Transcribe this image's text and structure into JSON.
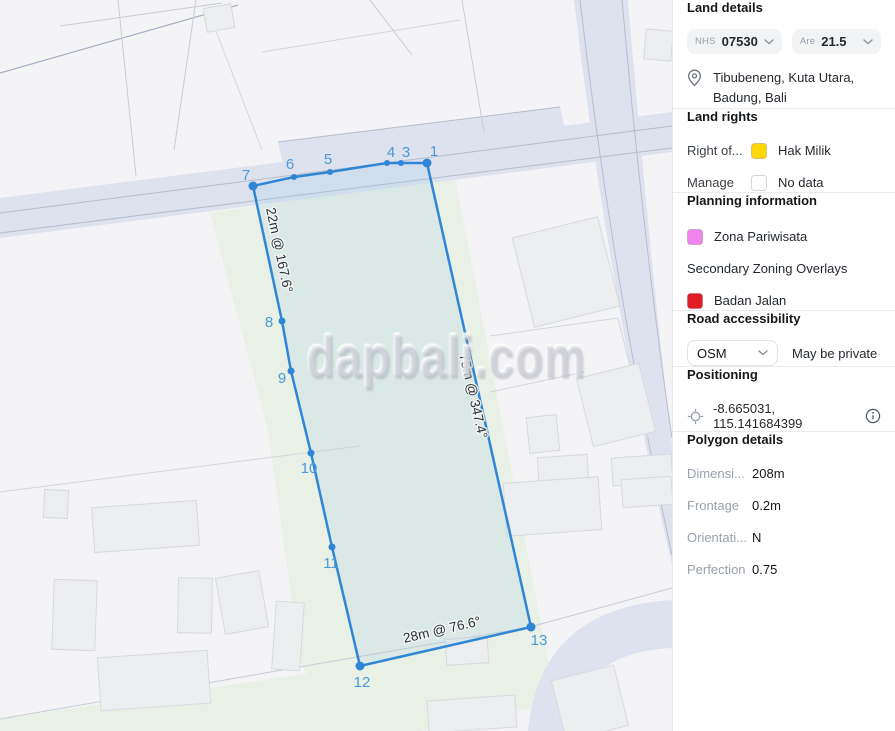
{
  "map": {
    "watermark": "dapbali.com",
    "colors": {
      "parcel_stroke": "#2F86D6"
    },
    "edge_labels": {
      "left": "22m @ 167.6°",
      "right": "75m @ 347.4°",
      "bottom": "28m @ 76.6°"
    },
    "vertex_labels": {
      "n1": "1",
      "n3": "3",
      "n4": "4",
      "n5": "5",
      "n6": "6",
      "n7": "7",
      "n8": "8",
      "n9": "9",
      "n10": "10",
      "n11": "11",
      "n12": "12",
      "n13": "13"
    }
  },
  "sidebar": {
    "land_details": {
      "title": "Land details",
      "nhs": {
        "label": "NHS",
        "value": "07530"
      },
      "are": {
        "label": "Are",
        "value": "21.5"
      },
      "location": "Tibubeneng, Kuta Utara, Badung, Bali"
    },
    "land_rights": {
      "title": "Land rights",
      "rows": [
        {
          "label": "Right of...",
          "value": "Hak Milik",
          "swatch": "#FFD60A"
        },
        {
          "label": "Manage",
          "value": "No data",
          "swatch": "#FFFFFF"
        }
      ]
    },
    "planning": {
      "title": "Planning information",
      "primary": {
        "label": "Zona Pariwisata",
        "swatch": "#F083EC"
      },
      "secondary_title": "Secondary Zoning Overlays",
      "secondary": {
        "label": "Badan Jalan",
        "swatch": "#E11D26"
      }
    },
    "road_accessibility": {
      "title": "Road accessibility",
      "source": "OSM",
      "note": "May be private"
    },
    "positioning": {
      "title": "Positioning",
      "coordinates": "-8.665031, 115.141684399"
    },
    "polygon_details": {
      "title": "Polygon details",
      "rows": [
        {
          "label": "Dimensi...",
          "value": "208m"
        },
        {
          "label": "Frontage",
          "value": "0.2m"
        },
        {
          "label": "Orientati...",
          "value": "N"
        },
        {
          "label": "Perfection",
          "value": "0.75"
        }
      ]
    }
  }
}
